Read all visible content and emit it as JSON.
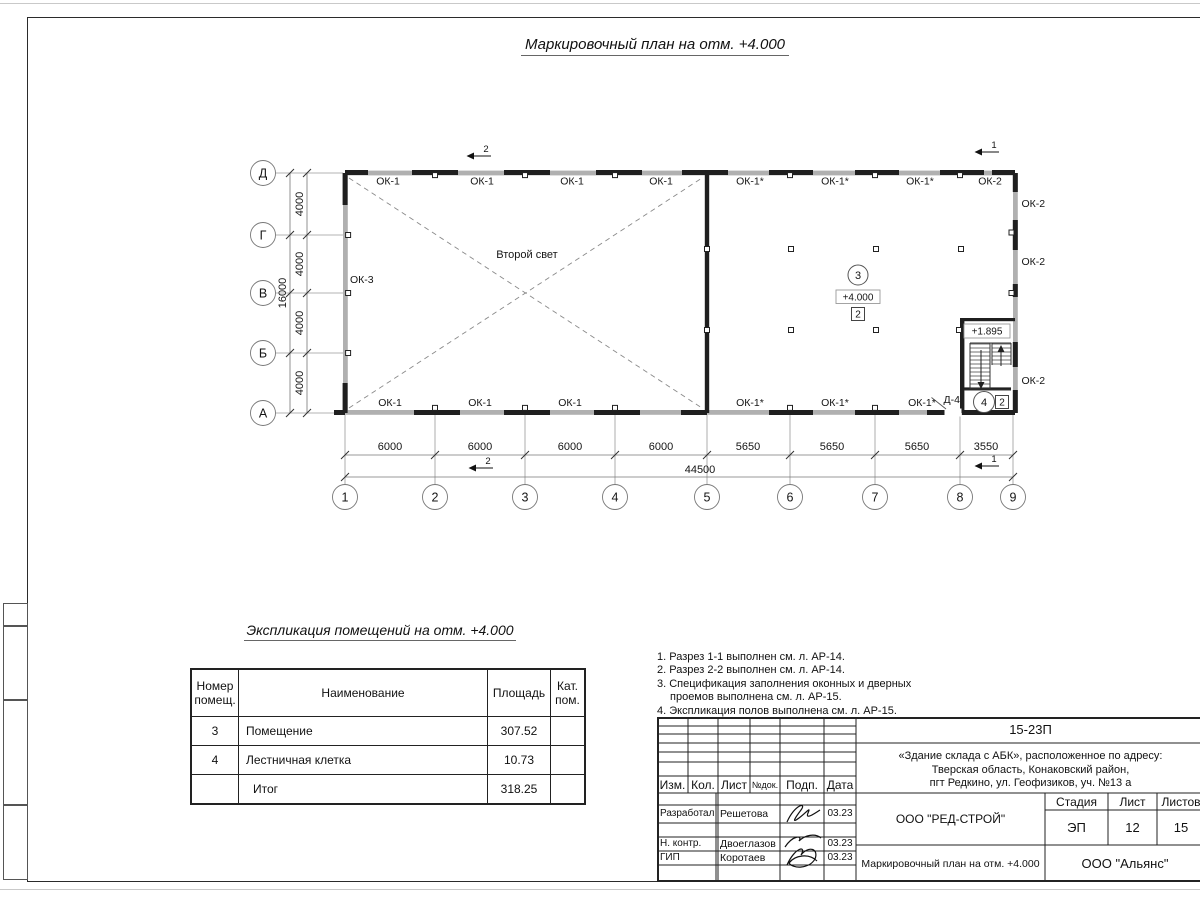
{
  "sheet": {
    "title": "Маркировочный план на отм. +4.000"
  },
  "plan": {
    "second_light": "Второй свет",
    "axes_bottom": [
      "1",
      "2",
      "3",
      "4",
      "5",
      "6",
      "7",
      "8",
      "9"
    ],
    "axes_left": [
      "Д",
      "Г",
      "В",
      "Б",
      "А"
    ],
    "dims_bottom": [
      "6000",
      "6000",
      "6000",
      "6000",
      "5650",
      "5650",
      "5650",
      "3550"
    ],
    "dim_total_bottom": "44500",
    "dims_left": [
      "4000",
      "4000",
      "4000",
      "4000"
    ],
    "dim_total_left": "16000",
    "windows_top": [
      "ОК-1",
      "ОК-1",
      "ОК-1",
      "ОК-1",
      "ОК-1*",
      "ОК-1*",
      "ОК-1*",
      "ОК-2"
    ],
    "windows_bottom": [
      "ОК-1",
      "ОК-1",
      "ОК-1",
      "ОК-1*",
      "ОК-1*",
      "ОК-1*"
    ],
    "windows_right": [
      "ОК-2",
      "ОК-2",
      "ОК-2"
    ],
    "window_left": "ОК-3",
    "sections": {
      "s1": "1",
      "s2": "2"
    },
    "room3": {
      "number": "3",
      "elevation": "+4.000",
      "category": "2"
    },
    "room4": {
      "number": "4",
      "category": "2",
      "door": "Д-4",
      "elevation": "+1.895"
    }
  },
  "schedule": {
    "title": "Экспликация помещений на отм. +4.000",
    "col_number": "Номер помещ.",
    "col_name": "Наименование",
    "col_area": "Площадь",
    "col_cat": "Кат. пом.",
    "rows": [
      {
        "num": "3",
        "name": "Помещение",
        "area": "307.52",
        "cat": ""
      },
      {
        "num": "4",
        "name": "Лестничная клетка",
        "area": "10.73",
        "cat": ""
      },
      {
        "num": "",
        "name": "Итог",
        "area": "318.25",
        "cat": ""
      }
    ]
  },
  "notes": {
    "n1": "1. Разрез 1-1 выполнен см. л. АР-14.",
    "n2": "2. Разрез 2-2 выполнен см. л. АР-14.",
    "n3a": "3. Спецификация заполнения оконных и дверных",
    "n3b": "проемов выполнена см. л. АР-15.",
    "n4": "4. Экспликация полов выполнена см. л. АР-15."
  },
  "titleblock": {
    "doc_number": "15-23П",
    "address1": "«Здание склада с АБК», расположенное по адресу:",
    "address2": "Тверская область, Конаковский район,",
    "address3": "пгт Редкино, ул. Геофизиков, уч. №13 а",
    "col_izm": "Изм.",
    "col_kol": "Кол.",
    "col_list": "Лист",
    "col_ndok": "№док.",
    "col_podp": "Подп.",
    "col_data": "Дата",
    "row1_role": "Разработал",
    "row1_name": "Решетова",
    "row1_date": "03.23",
    "row2_role": "Н. контр.",
    "row2_name": "Двоеглазов",
    "row2_date": "03.23",
    "row3_role": "ГИП",
    "row3_name": "Коротаев",
    "row3_date": "03.23",
    "org1": "ООО \"РЕД-СТРОЙ\"",
    "stage_label": "Стадия",
    "list_label": "Лист",
    "listov_label": "Листов",
    "stage": "ЭП",
    "list_num": "12",
    "listov_num": "15",
    "drawing_title": "Маркировочный план на отм. +4.000",
    "org2": "ООО \"Альянс\""
  }
}
